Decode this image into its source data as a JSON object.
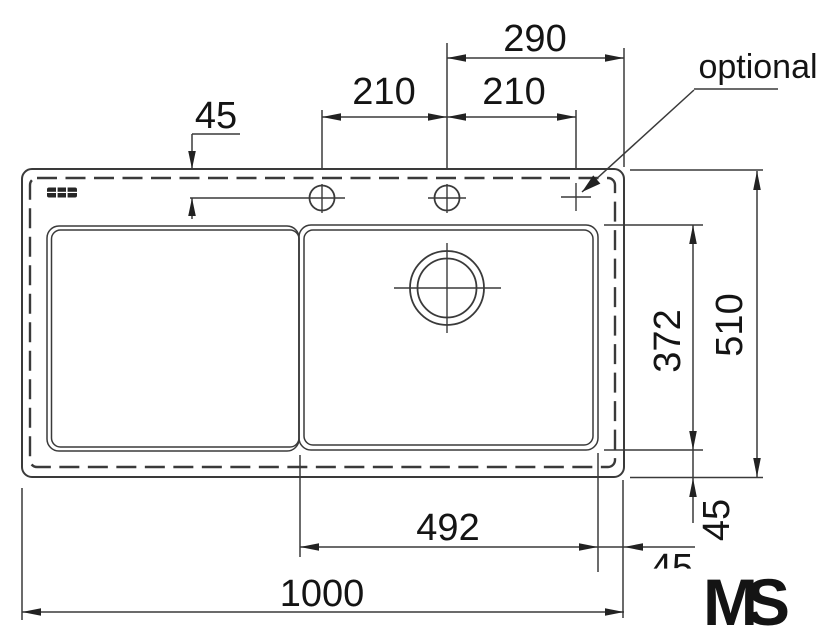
{
  "labels": {
    "optional": "optional"
  },
  "dims": {
    "top_hole_offset_45": "45",
    "hole_spacing_left_210": "210",
    "hole_spacing_right_210": "210",
    "hole_to_edge_290": "290",
    "basin_depth_372": "372",
    "overall_depth_510": "510",
    "basin_width_492": "492",
    "overall_width_1000": "1000",
    "right_edge_45": "45",
    "bottom_edge_45": "45"
  },
  "logo": {
    "m": "M",
    "s": "S"
  },
  "colors": {
    "line": "#3a3a3a",
    "text": "#141414",
    "logo_m": "#3ed200",
    "logo_s": "#2d3a48",
    "background": "#ffffff"
  }
}
